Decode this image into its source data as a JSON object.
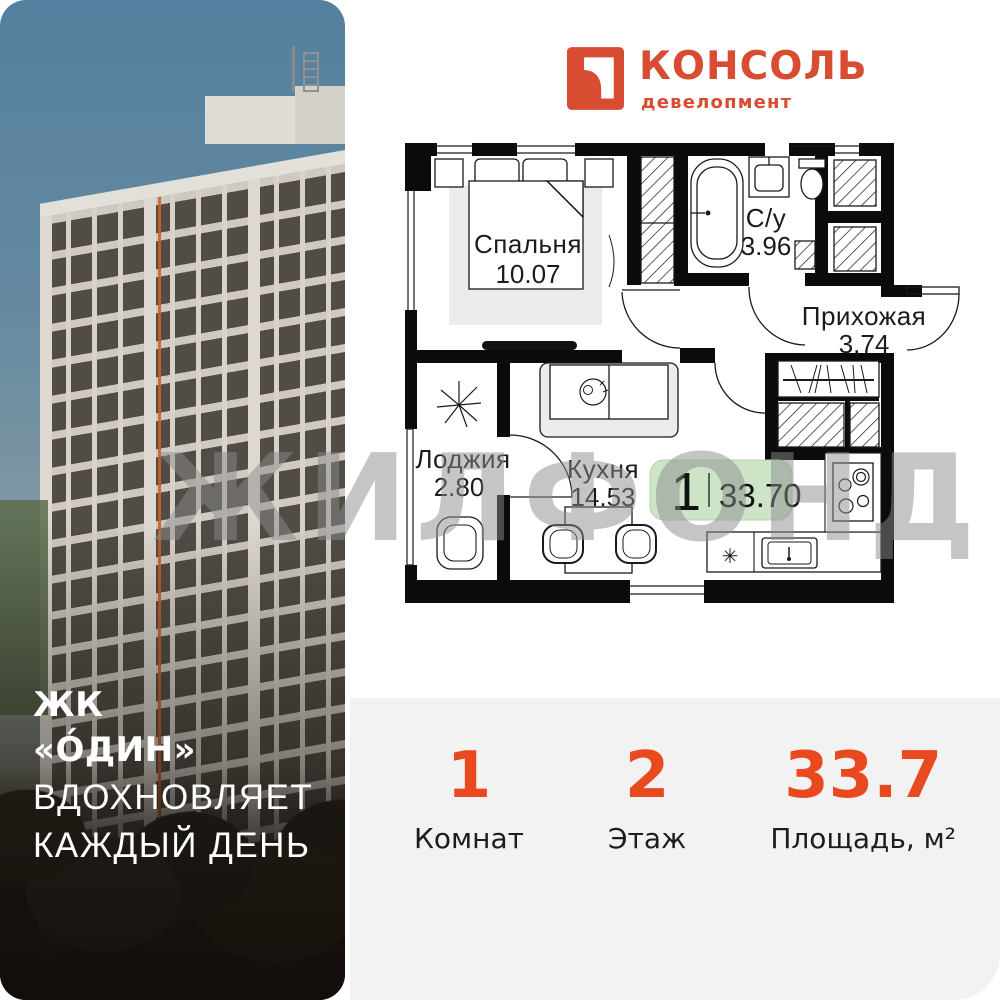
{
  "brand": {
    "name": "КОНСОЛЬ",
    "tagline": "девелопмент",
    "color": "#D84C32"
  },
  "project": {
    "line1": "ЖК",
    "line2": "«О́ДИН»",
    "line3": "ВДОХНОВЛЯЕТ",
    "line4": "КАЖДЫЙ ДЕНЬ"
  },
  "watermark": {
    "text": "ЖИЛФОНД"
  },
  "floorplan": {
    "rooms": [
      {
        "name": "Спальня",
        "area": "10.07"
      },
      {
        "name": "С/у",
        "area": "3.96"
      },
      {
        "name": "Прихожая",
        "area": "3.74"
      },
      {
        "name": "Лоджия",
        "area": "2.80"
      },
      {
        "name": "Кухня",
        "area": "14.53"
      }
    ],
    "badge": {
      "rooms": "1",
      "area": "33.70",
      "bg": "#CDE4C6"
    },
    "symbols": {
      "star": "✳"
    }
  },
  "stats": [
    {
      "value": "1",
      "label": "Комнат"
    },
    {
      "value": "2",
      "label": "Этаж"
    },
    {
      "value": "33.7",
      "label": "Площадь, м²"
    }
  ],
  "colors": {
    "accent": "#E8491F",
    "panel_bg": "#F2F2F3",
    "badge_bg": "#CDE4C6"
  }
}
